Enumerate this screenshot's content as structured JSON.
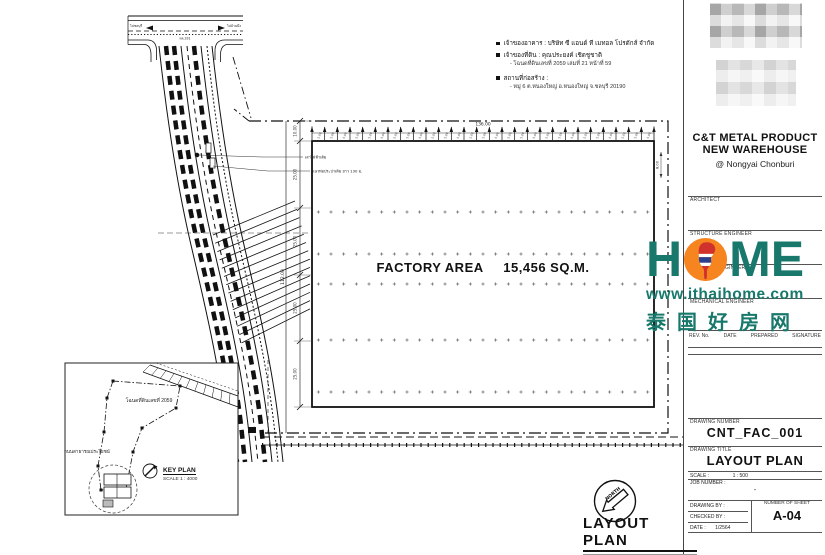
{
  "colors": {
    "teal": "#17786b",
    "orange": "#f6851f",
    "line": "#111111"
  },
  "annotations": {
    "owner_building": "เจ้าของอาคาร : บริษัท ซี แอนด์ ที เมทอล โปรดักส์ จำกัด",
    "owner_land": "เจ้าของที่ดิน : คุณประยงค์ เชิดชูชาติ",
    "deed": "- โฉนดที่ดินเลขที่ 2059 เล่มที่ 21 หน้าที่ 59",
    "site_label": "สถานที่ก่อสร้าง :",
    "site_detail": "- หมู่ 6 ต.หนองใหญ่ อ.หนองใหญ่ จ.ชลบุรี 20190"
  },
  "factory": {
    "label": "FACTORY AREA",
    "area": "15,456 SQ.M.",
    "bays": 27,
    "bay_label": "5.00",
    "total_width": "136.00",
    "total_height": "112.00",
    "side_dims": [
      "10.00",
      "25.00",
      "25.00",
      "25.00",
      "25.00"
    ],
    "right_dim": "8.00",
    "grid_cols": 27
  },
  "road": {
    "dest_left": "ไปชลบุรี",
    "dest_right": "ไปบ้านบึง",
    "road_name": "ทล.331",
    "note1": "เสาไฟฟ้าเดิม",
    "note2": "แนวท่อประปาเดิม ยาว 130 ม."
  },
  "keyplan": {
    "title": "KEY PLAN",
    "scale": "SCALE 1 : 4000",
    "deed_text": "โฉนดที่ดินเลขที่ 2059",
    "road_text": "ถนนสาธารณประโยชน์"
  },
  "north_label": "NORTH",
  "main_title": {
    "title": "LAYOUT PLAN",
    "scale_label": "SCALE",
    "scale_value": "1 : 500"
  },
  "titleblock": {
    "project1": "C&T METAL PRODUCT",
    "project2": "NEW WAREHOUSE",
    "project3": "@ Nongyai Chonburi",
    "architect": "ARCHITECT",
    "structure": "STRUCTURE ENGINEER",
    "sanitary": "SANITARY ENGINEER",
    "mechanical": "MECHANICAL ENGINEER",
    "rev_headers": [
      "REV. No.",
      "DATE",
      "PREPARED",
      "SIGNATURE"
    ],
    "drawing_number_label": "DRAWING NUMBER",
    "drawing_number": "CNT_FAC_001",
    "drawing_title_label": "DRAWING TITLE",
    "drawing_title": "LAYOUT PLAN",
    "scale_label": "SCALE :",
    "scale_value": "1 : 500",
    "job_label": "JOB NUMBER :",
    "job_value": "-",
    "drawn_label": "DRAWING BY :",
    "checked_label": "CHECKED BY :",
    "date_label": "DATE :",
    "date_value": "1/2564",
    "sheet_label": "NUMBER OF SHEET",
    "sheet_value": "A-04"
  },
  "logo": {
    "h": "H",
    "m": "M",
    "e": "E",
    "url": "www.ithaihome.com",
    "chinese": "泰国好房网"
  }
}
